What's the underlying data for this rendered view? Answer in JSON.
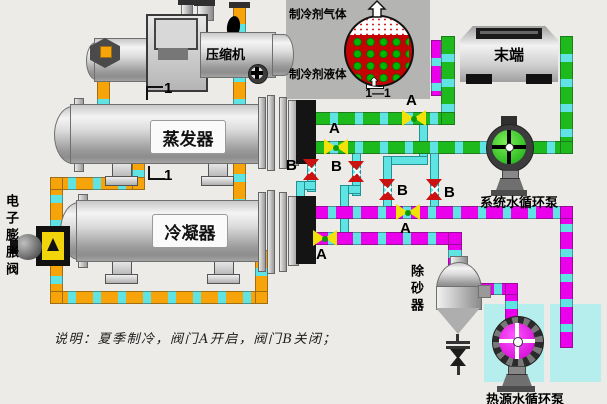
{
  "equipment": {
    "compressor": "压缩机",
    "evaporator": "蒸发器",
    "condenser": "冷凝器",
    "expansion_valve": "电子膨胀阀",
    "terminal_unit": "末端",
    "system_water_pump": "系统水循环泵",
    "heat_source_water_pump": "热源水循环泵",
    "sand_remover": "除砂器"
  },
  "inset_view": {
    "gas_label": "制冷剂气体",
    "liquid_label": "制冷剂液体",
    "section_title": "1—1"
  },
  "valve_labels": {
    "open": "A",
    "closed": "B"
  },
  "section_mark": "1",
  "note_text": "说明：夏季制冷，阀门A开启，阀门B关闭；",
  "colors": {
    "refrigerant_pipe": "#F7A40A",
    "chilled_water_pipe": "#1DB91D",
    "heat_water_pipe": "#EA00EA",
    "water_dash": "#5FE3E3",
    "open_valve": "#F2E20A",
    "closed_valve": "#CC1111"
  }
}
